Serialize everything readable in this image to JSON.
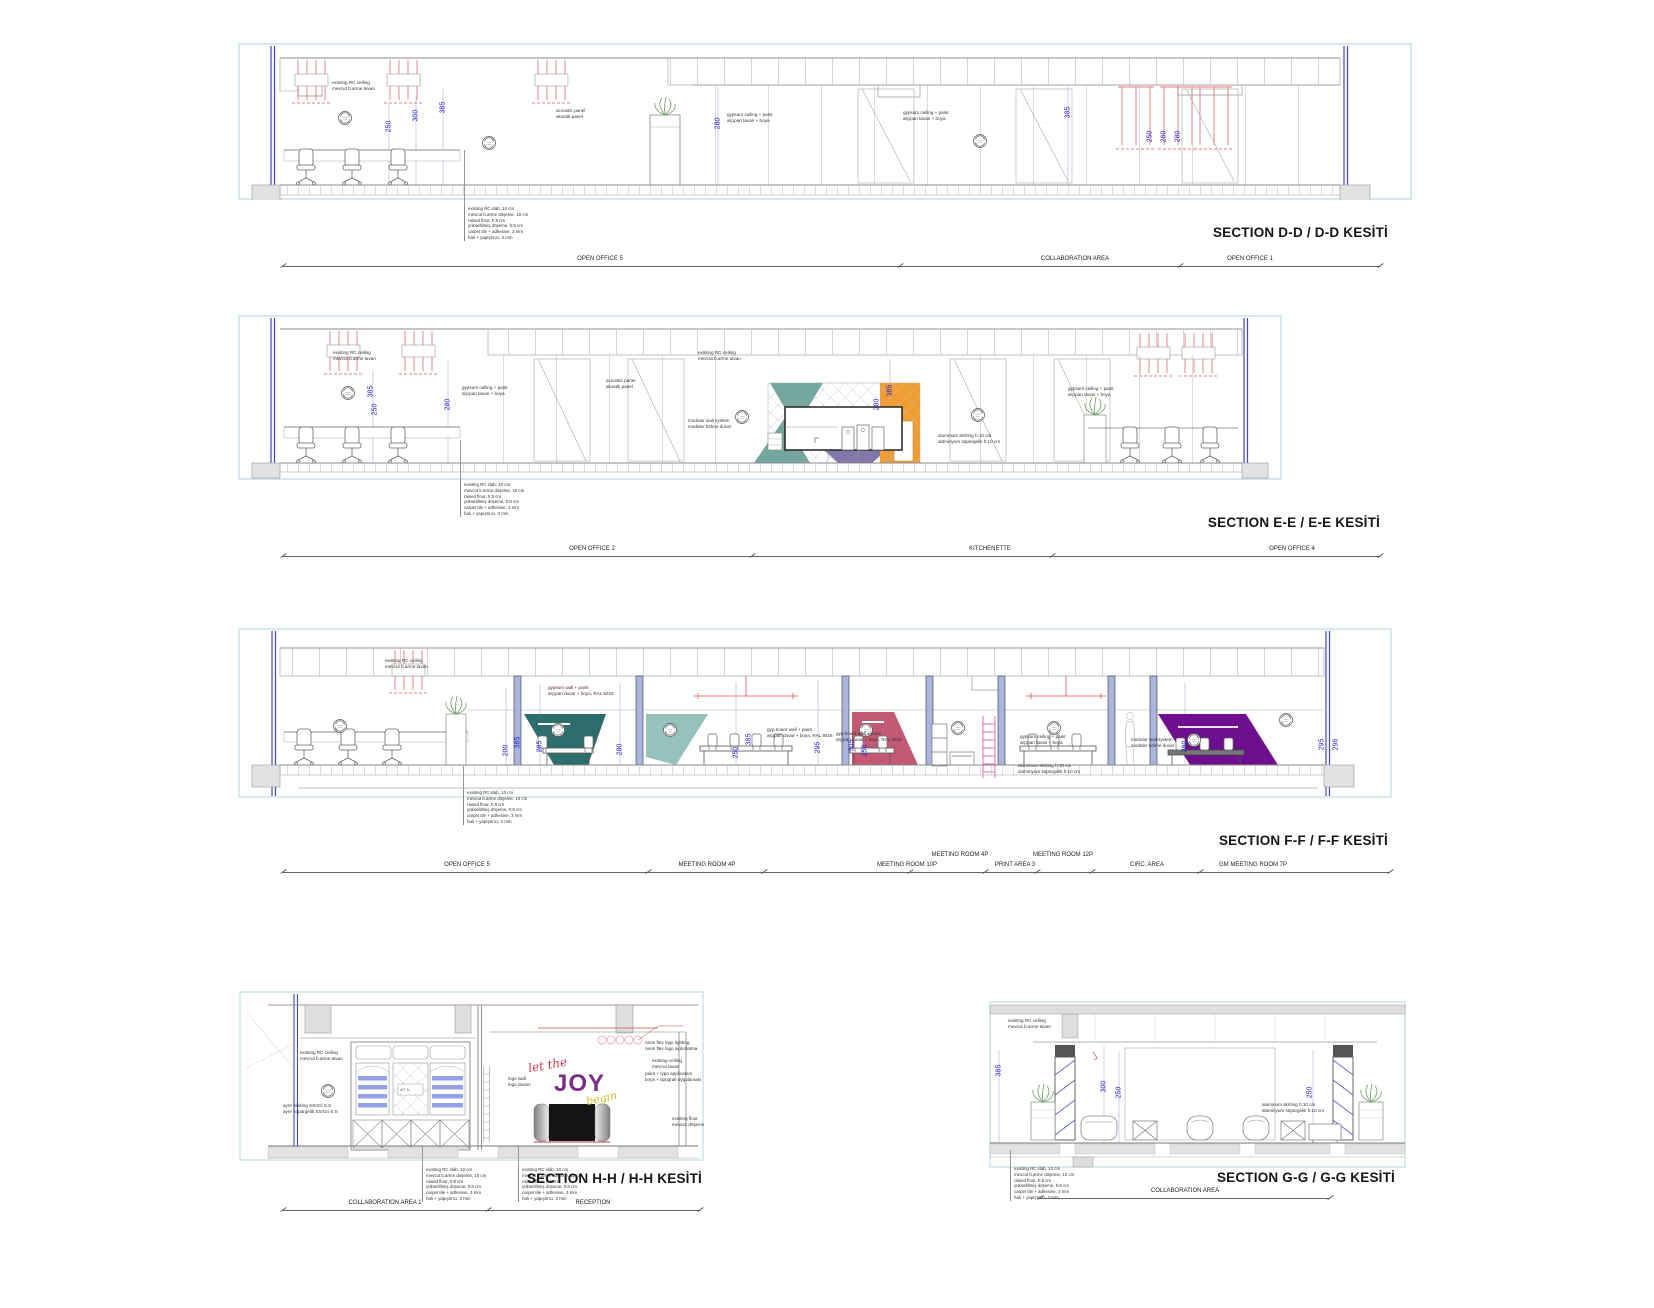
{
  "sheet": {
    "width": 1654,
    "height": 1308,
    "background": "#ffffff"
  },
  "palette": {
    "panel_border": "#bde0e6",
    "structure_blue": "#3f48c0",
    "dimension_blue": "#2323d8",
    "light_red": "#e05252",
    "ladder_pink": "#e06bb0",
    "teal_dark": "#2d6e6d",
    "teal_light": "#96c2bd",
    "kitchen_teal": "#74a79f",
    "kitchen_purple": "#8478aa",
    "kitchen_orange": "#f09d33",
    "wall_rose": "#c25a76",
    "wall_violet": "#6d0f8f",
    "shelf_blue": "#97a1ea",
    "joy_red": "#c8374b",
    "joy_purple": "#7b2d86",
    "joy_yellow": "#c9b832"
  },
  "shared": {
    "ceiling_note": [
      "existing RC ceiling",
      "mevcut b.arme tavan"
    ],
    "ceiling_note2": [
      "existing ceiling",
      "mevcut tavan"
    ],
    "acoustic_note": [
      "acoustic panel",
      "akustik panel"
    ],
    "gypsum_ceiling_note": [
      "gypsum ceiling + paint",
      "alçıpan tavan + boya"
    ],
    "skirting_note": [
      "aluminum skirting h:10 cm",
      "alüminyum süpürgelik h:10 cm"
    ],
    "modular_note": [
      "modular wall system",
      "modüler bölme duvar"
    ],
    "floor_buildup": [
      "existing RC slab, 10 cm",
      "mevcut b.arme döşeme, 10 cm",
      "raised floor, h:8 cm",
      "yükseltilmiş döşeme, h:8 cm",
      "carpet tile + adhesive, 3 mm",
      "halı + yapıştırıcı, 3 mm"
    ]
  },
  "sections": {
    "dd": {
      "title": "SECTION D-D / D-D KESİTİ",
      "rooms": [
        "OPEN OFFICE 5",
        "COLLABORATION AREA",
        "OPEN OFFICE 1"
      ],
      "dims": [
        "250",
        "300",
        "385",
        "280",
        "385",
        "250",
        "260",
        "280"
      ]
    },
    "ee": {
      "title": "SECTION E-E / E-E KESİTİ",
      "rooms": [
        "OPEN OFFICE 2",
        "KITCHENETTE",
        "OPEN OFFICE 4"
      ],
      "dims": [
        "385",
        "250",
        "280",
        "280",
        "385"
      ]
    },
    "ff": {
      "title": "SECTION F-F / F-F KESİTİ",
      "rooms": [
        "OPEN OFFICE 5",
        "MEETING ROOM 4P",
        "MEETING ROOM 10P",
        "MEETING ROOM 4P",
        "PRINT AREA 3",
        "MEETING ROOM 12P",
        "CIRC. AREA",
        "GM MEETING ROOM 7P"
      ],
      "dims": [
        "200",
        "385",
        "295",
        "280",
        "250",
        "385",
        "295",
        "305",
        "250",
        "280",
        "295",
        "296"
      ],
      "wall_paint_teal": [
        "gypsum wall + paint",
        "alçıpan duvar + boya, RAL 5018"
      ],
      "wall_paint_white": [
        "gyp.board wall + paint",
        "alçıpan duvar + boya, RAL 9016"
      ]
    },
    "hh": {
      "title": "SECTION H-H / H-H KESİTİ",
      "rooms": [
        "COLLABORATION AREA 1",
        "RECEPTION"
      ],
      "logo_wall_note": [
        "logo wall",
        "logo duvarı"
      ],
      "skirting_ss_note": [
        "ayre skirting SS/Gri S.S",
        "ayre süpürgelik SS/Gri S.S"
      ],
      "neon_note": [
        "neon flex logo lighting",
        "neon flex logo aydınlatma"
      ],
      "typo_note": [
        "paint + typo application",
        "boya + tipografi uygulaması"
      ],
      "floor_note": [
        "existing floor",
        "mevcut döşeme"
      ],
      "tv_label": "40\" tv",
      "artwork": {
        "line1": "let the",
        "line2": "JOY",
        "line3": "begin"
      }
    },
    "gg": {
      "title": "SECTION G-G / G-G KESİTİ",
      "rooms": [
        "COLLABORATION AREA"
      ],
      "dims": [
        "385",
        "300",
        "250",
        "250"
      ]
    }
  }
}
